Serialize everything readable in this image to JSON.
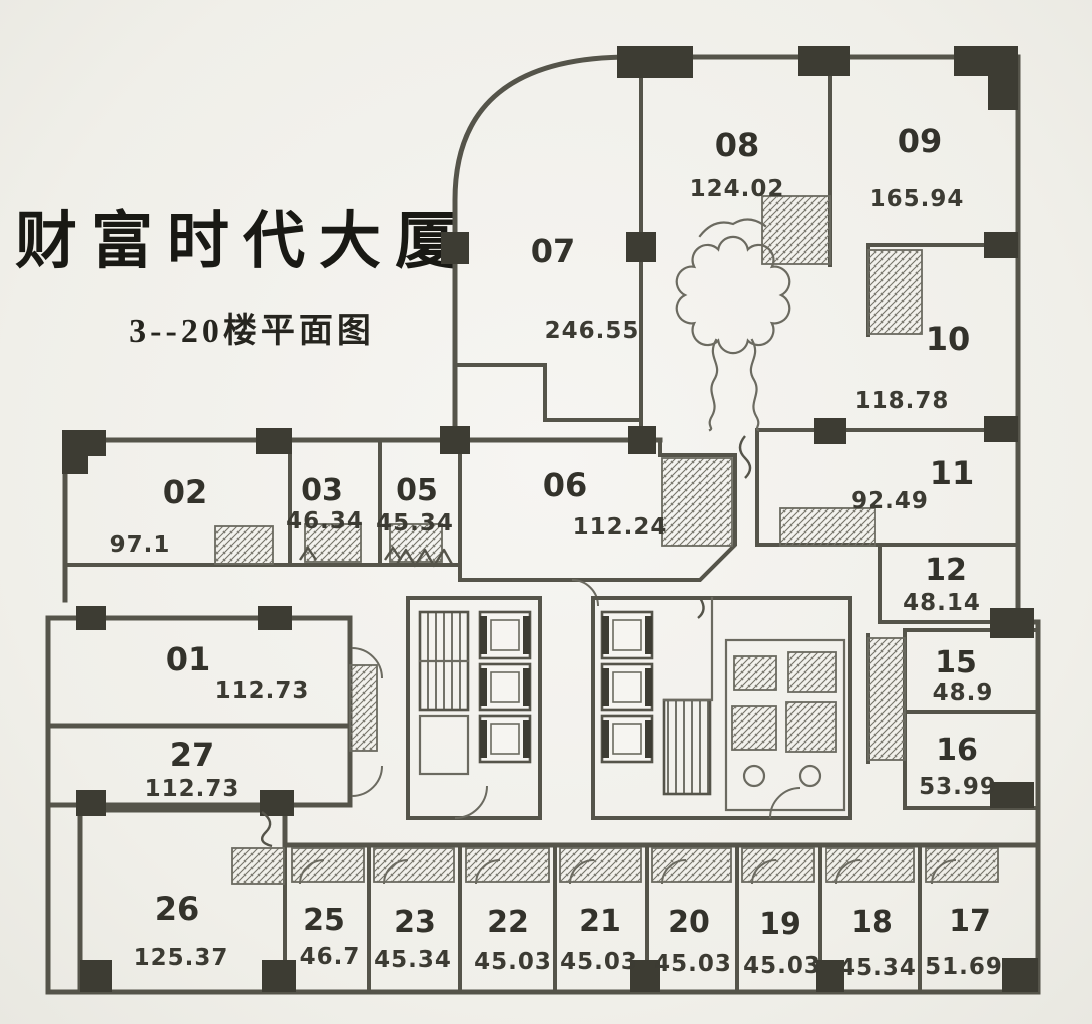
{
  "title": "财富时代大厦",
  "subtitle": "3--20楼平面图",
  "colors": {
    "paper": "#f3f2ee",
    "wall": "#55544a",
    "column": "#3d3c33",
    "ink": "#33322b"
  },
  "rooms": {
    "r01": {
      "number": "01",
      "area": "112.73"
    },
    "r02": {
      "number": "02",
      "area": "97.1"
    },
    "r03": {
      "number": "03",
      "area": "46.34"
    },
    "r05": {
      "number": "05",
      "area": "45.34"
    },
    "r06": {
      "number": "06",
      "area": "112.24"
    },
    "r07": {
      "number": "07",
      "area": "246.55"
    },
    "r08": {
      "number": "08",
      "area": "124.02"
    },
    "r09": {
      "number": "09",
      "area": "165.94"
    },
    "r10": {
      "number": "10",
      "area": "118.78"
    },
    "r11": {
      "number": "11",
      "area": "92.49"
    },
    "r12": {
      "number": "12",
      "area": "48.14"
    },
    "r15": {
      "number": "15",
      "area": "48.9"
    },
    "r16": {
      "number": "16",
      "area": "53.99"
    },
    "r17": {
      "number": "17",
      "area": "51.69"
    },
    "r18": {
      "number": "18",
      "area": "45.34"
    },
    "r19": {
      "number": "19",
      "area": "45.03"
    },
    "r20": {
      "number": "20",
      "area": "45.03"
    },
    "r21": {
      "number": "21",
      "area": "45.03"
    },
    "r22": {
      "number": "22",
      "area": "45.03"
    },
    "r23": {
      "number": "23",
      "area": "45.34"
    },
    "r25": {
      "number": "25",
      "area": "46.7"
    },
    "r26": {
      "number": "26",
      "area": "125.37"
    },
    "r27": {
      "number": "27",
      "area": "112.73"
    }
  }
}
